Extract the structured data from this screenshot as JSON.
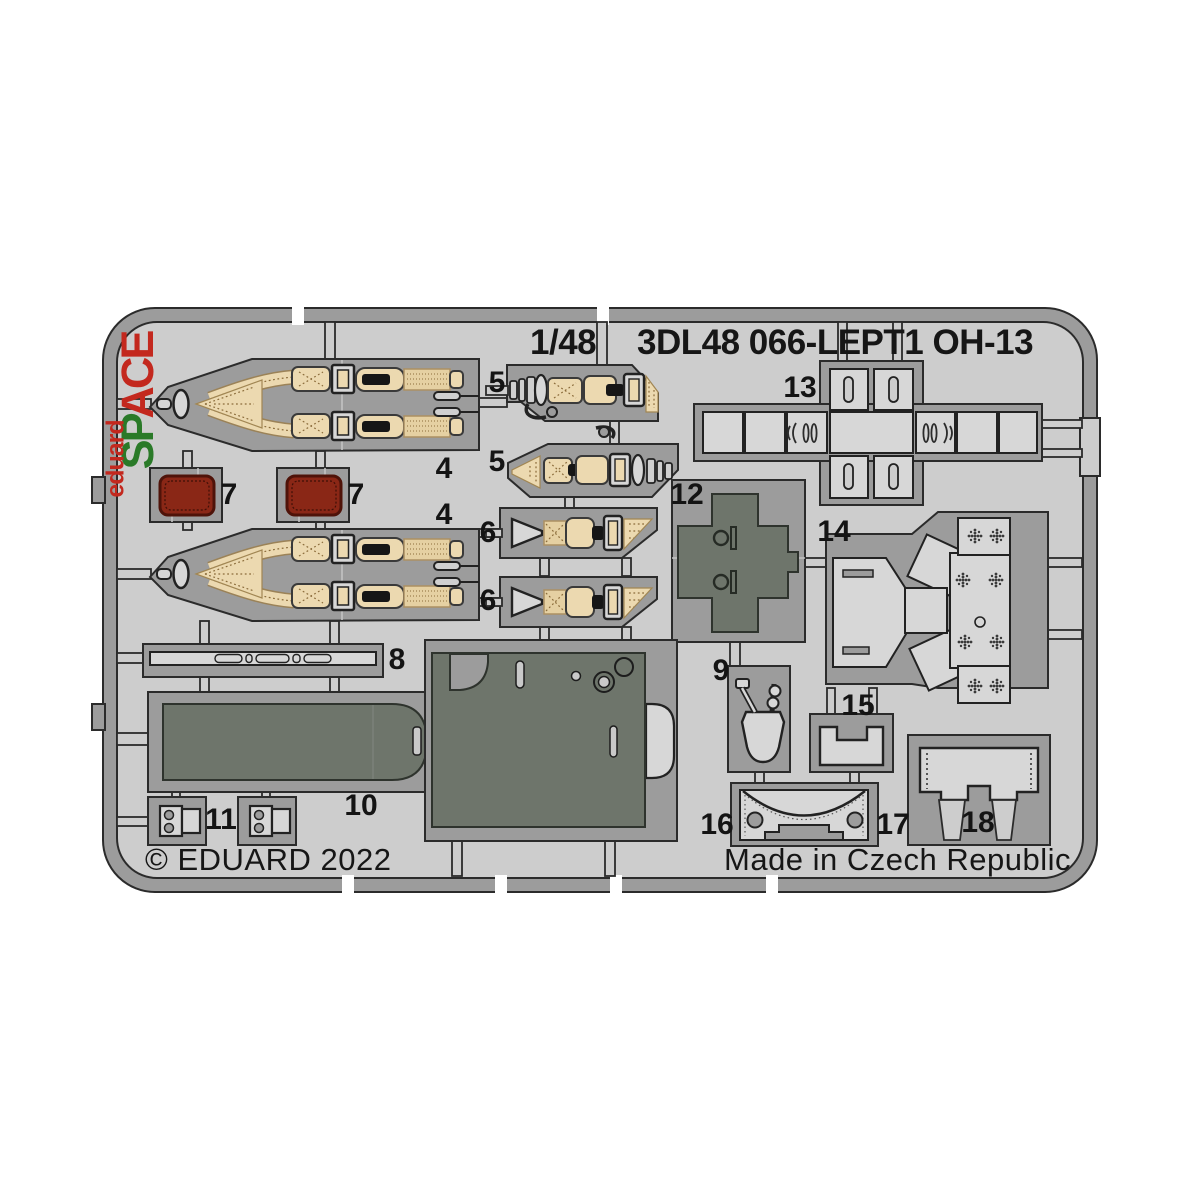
{
  "product": {
    "scale": "1/48",
    "code": "3DL48 066-LEPT1 OH-13"
  },
  "branding": {
    "logo_text": "eduard",
    "logo_series_prefix": "SP",
    "logo_series_suffix": "ACE"
  },
  "footer": {
    "copyright": "© EDUARD 2022",
    "made_in": "Made in Czech Republic"
  },
  "parts": [
    {
      "id": "4-upper-harness",
      "label": "4"
    },
    {
      "id": "4-lower-harness",
      "label": "4"
    },
    {
      "id": "5-upper-belt",
      "label": "5"
    },
    {
      "id": "5-lower-belt",
      "label": "5"
    },
    {
      "id": "6-upper-belt",
      "label": "6"
    },
    {
      "id": "6-lower-belt",
      "label": "6"
    },
    {
      "id": "7-left-cushion",
      "label": "7"
    },
    {
      "id": "7-right-cushion",
      "label": "7"
    },
    {
      "id": "8-strip",
      "label": "8"
    },
    {
      "id": "9-levers",
      "label": "9"
    },
    {
      "id": "10-floor-panel",
      "label": "10"
    },
    {
      "id": "11-buckles",
      "label": "11"
    },
    {
      "id": "12-console",
      "label": "12"
    },
    {
      "id": "13-panel-cross",
      "label": "13"
    },
    {
      "id": "14-structure",
      "label": "14"
    },
    {
      "id": "15-bracket",
      "label": "15"
    },
    {
      "id": "16-left-frame",
      "label": "16"
    },
    {
      "id": "17-right-frame",
      "label": "17"
    },
    {
      "id": "18-rear-panel",
      "label": "18"
    }
  ],
  "colors": {
    "background": "#ffffff",
    "fret_surface": "#cdcdcd",
    "fret_metal": "#9c9c9c",
    "outline": "#2b2b2b",
    "panel_light": "#d7d7d7",
    "painted_dark_part": "#6e756b",
    "seatbelt_tan": "#ecd9b0",
    "cushion_red": "#8a2716",
    "logo_red": "#c3281e",
    "logo_green": "#2a7a28",
    "text": "#161616"
  }
}
